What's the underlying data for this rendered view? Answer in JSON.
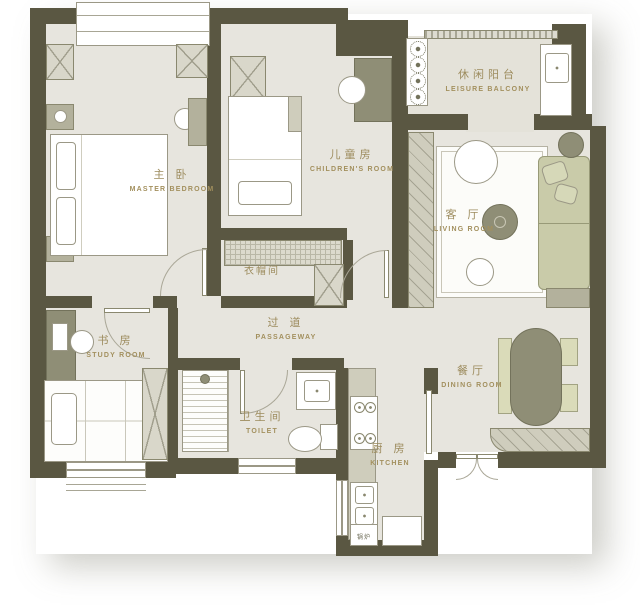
{
  "palette": {
    "wall": "#5a5742",
    "floor": "#e7e5de",
    "accent_dark": "#8f8e76",
    "furniture": "#d9d7ca",
    "sofa": "#c9cba9",
    "bench": "#dadbb9",
    "label_text": "#9d8c5e",
    "outline": "#9b9886",
    "white": "#ffffff"
  },
  "rooms": {
    "leisure_balcony": {
      "zh": "休闲阳台",
      "en": "LEISURE BALCONY"
    },
    "master_bedroom": {
      "zh": "主 卧",
      "en": "MASTER BEDROOM"
    },
    "children_room": {
      "zh": "儿童房",
      "en": "CHILDREN'S ROOM"
    },
    "living_room": {
      "zh": "客 厅",
      "en": "LIVING ROOM"
    },
    "cloakroom": {
      "zh": "衣帽间",
      "en": ""
    },
    "passageway": {
      "zh": "过 道",
      "en": "PASSAGEWAY"
    },
    "study_room": {
      "zh": "书 房",
      "en": "STUDY ROOM"
    },
    "toilet": {
      "zh": "卫生间",
      "en": "TOILET"
    },
    "kitchen": {
      "zh": "厨 房",
      "en": "KITCHEN"
    },
    "dining_room": {
      "zh": "餐厅",
      "en": "DINING ROOM"
    },
    "boiler": {
      "zh": "锅炉",
      "en": ""
    }
  }
}
